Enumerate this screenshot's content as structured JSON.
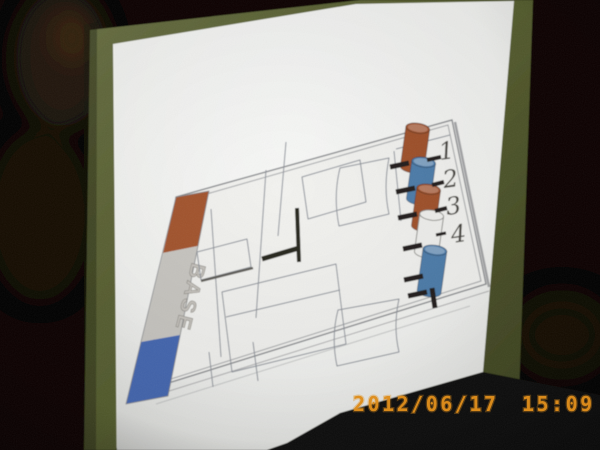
{
  "photo": {
    "timestamp": "2012/06/17 15:09",
    "timestamp_color": "#de8d1c"
  },
  "screen": {
    "surface_color": "#5b6331",
    "room_color": "#070605",
    "slide_color": "#f1f2ef"
  },
  "slide": {
    "diagram": {
      "base_label": "BASE",
      "outline_color": "#85878b",
      "bar_segments": [
        {
          "name": "top",
          "color": "#a4552d"
        },
        {
          "name": "middle",
          "color": "#c9c7c2"
        },
        {
          "name": "bottom",
          "color": "#4467b2"
        }
      ],
      "cylinders": [
        {
          "label": "1",
          "color": "#a0512b"
        },
        {
          "label": "2",
          "color": "#4e7dab"
        },
        {
          "label": "3",
          "color": "#a0512b"
        },
        {
          "label": "4",
          "color": "#f1f1ee"
        },
        {
          "label": "",
          "color": "#4e7dab"
        }
      ]
    }
  }
}
